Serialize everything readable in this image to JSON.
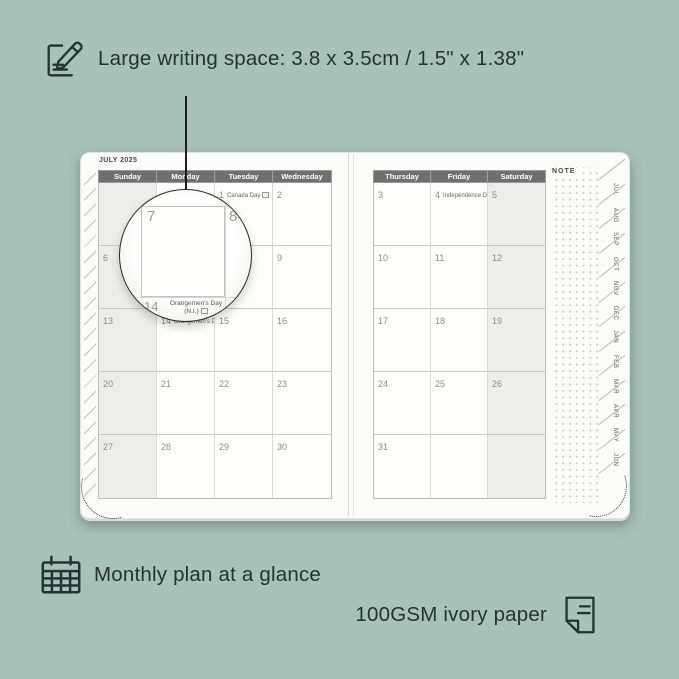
{
  "colors": {
    "background": "#a8c1b9",
    "ink": "#243430",
    "page": "#fbfbf9",
    "header_band": "#6f6f6f",
    "weekend": "#ececeb",
    "date_text": "#8d8d8d"
  },
  "features": {
    "writing_space": {
      "icon": "pencil-note-icon",
      "text": "Large writing space: 3.8 x 3.5cm / 1.5\" x 1.38\""
    },
    "monthly_plan": {
      "icon": "calendar-icon",
      "text": "Monthly plan at a glance"
    },
    "paper": {
      "icon": "paper-icon",
      "text": "100GSM ivory paper"
    }
  },
  "planner": {
    "month_title": "JULY 2025",
    "note_label": "NOTE",
    "left_page": {
      "day_headers": [
        "Sunday",
        "Monday",
        "Tuesday",
        "Wednesday"
      ],
      "weeks": [
        [
          {
            "d": ""
          },
          {
            "d": ""
          },
          {
            "d": "1",
            "h": "Canada Day",
            "flag": true
          },
          {
            "d": "2"
          }
        ],
        [
          {
            "d": "6"
          },
          {
            "d": "7"
          },
          {
            "d": "8"
          },
          {
            "d": "9"
          }
        ],
        [
          {
            "d": "13"
          },
          {
            "d": "14",
            "h": "Orangemen's Day (N.I.)",
            "flag": true
          },
          {
            "d": "15"
          },
          {
            "d": "16"
          }
        ],
        [
          {
            "d": "20"
          },
          {
            "d": "21"
          },
          {
            "d": "22"
          },
          {
            "d": "23"
          }
        ],
        [
          {
            "d": "27"
          },
          {
            "d": "28"
          },
          {
            "d": "29"
          },
          {
            "d": "30"
          }
        ]
      ]
    },
    "right_page": {
      "day_headers": [
        "Thursday",
        "Friday",
        "Saturday"
      ],
      "weeks": [
        [
          {
            "d": "3"
          },
          {
            "d": "4",
            "h": "Independence Day",
            "flag": true
          },
          {
            "d": "5"
          }
        ],
        [
          {
            "d": "10"
          },
          {
            "d": "11"
          },
          {
            "d": "12"
          }
        ],
        [
          {
            "d": "17"
          },
          {
            "d": "18"
          },
          {
            "d": "19"
          }
        ],
        [
          {
            "d": "24"
          },
          {
            "d": "25"
          },
          {
            "d": "26"
          }
        ],
        [
          {
            "d": "31"
          },
          {
            "d": ""
          },
          {
            "d": ""
          }
        ]
      ]
    },
    "month_tabs": [
      "JUL",
      "AUG",
      "SEP",
      "OCT",
      "NOV",
      "DEC",
      "JAN",
      "FEB",
      "MAR",
      "APR",
      "MAY",
      "JUN"
    ]
  },
  "magnifier": {
    "day_a": "7",
    "day_b": "8",
    "partial_day": "14",
    "holiday_line1": "Orangemen's Day",
    "holiday_line2": "(N.I.)"
  }
}
